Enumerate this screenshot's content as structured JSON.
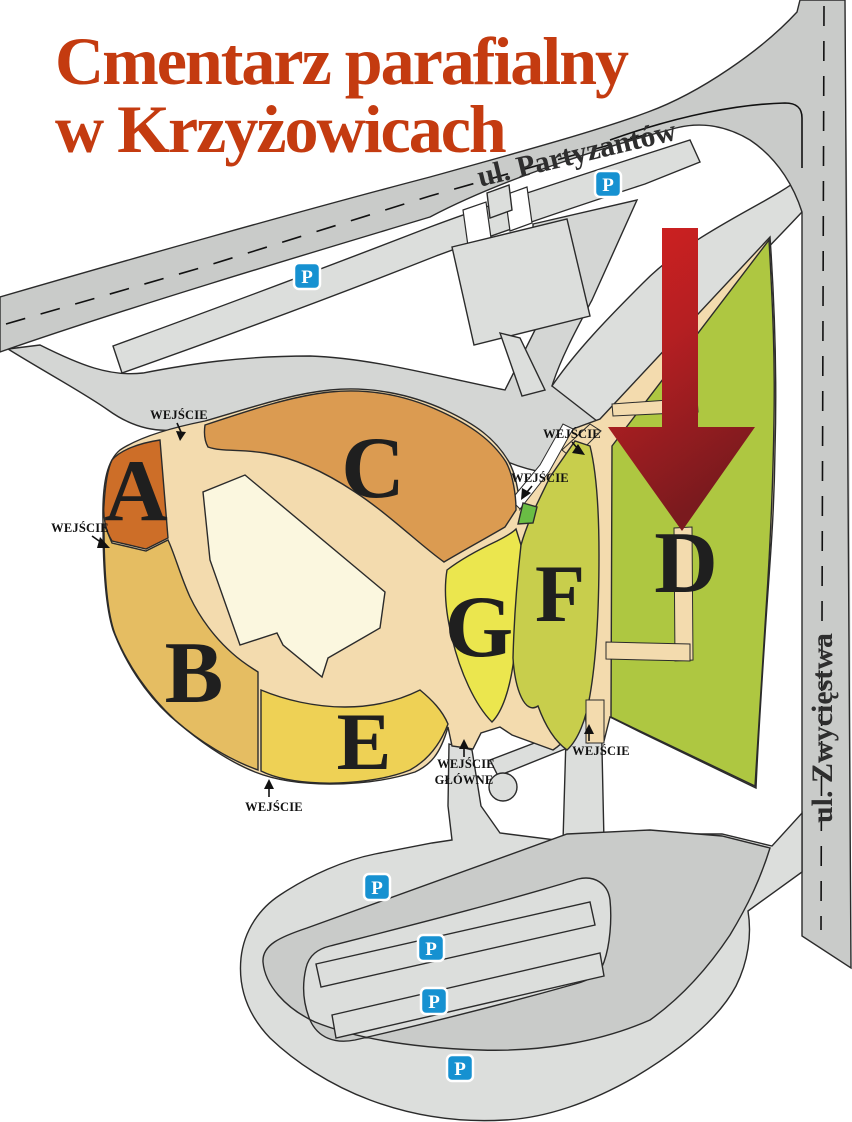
{
  "title": {
    "line1": "Cmentarz parafialny",
    "line2": "w Krzyżowicach",
    "color": "#c43b10"
  },
  "streets": {
    "partyzantow": "ul. Partyzantów",
    "zwyciestwa": "ul. Zwycięstwa"
  },
  "sections": [
    {
      "label": "A",
      "color": "#cd6e28"
    },
    {
      "label": "B",
      "color": "#e5bd62"
    },
    {
      "label": "C",
      "color": "#db9b51"
    },
    {
      "label": "D",
      "color": "#aec741"
    },
    {
      "label": "E",
      "color": "#eed155"
    },
    {
      "label": "F",
      "color": "#c8ce4c"
    },
    {
      "label": "G",
      "color": "#ebe64e"
    }
  ],
  "entrances": {
    "side_label": "WEJŚCIE",
    "main_line1": "WEJŚCIE",
    "main_line2": "GŁÓWNE"
  },
  "parking": {
    "label": "P",
    "sign_color": "#1691d1",
    "count": 6
  },
  "colors": {
    "path_tan": "#f3dbae",
    "building_cream": "#fbf7df",
    "gate_green": "#6abd44",
    "road_main": "#c9cbc9",
    "road_curved": "#d4d6d4",
    "road_light": "#dcdedc",
    "building_gray": "#dcdedc",
    "arrow_top": "#d32020",
    "arrow_bottom": "#7a1a1e"
  }
}
